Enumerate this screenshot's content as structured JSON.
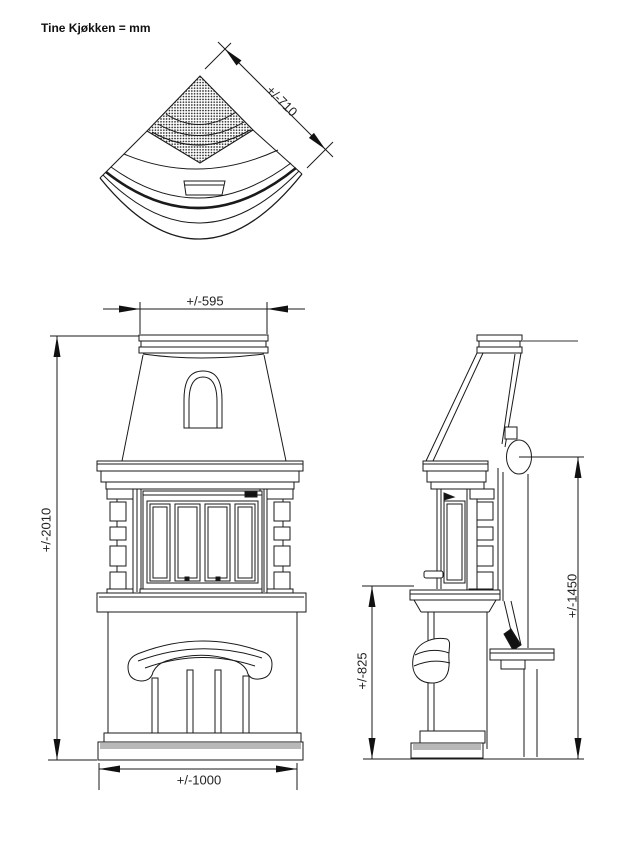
{
  "title": "Tine Kjøkken = mm",
  "drawing": {
    "top_view": {
      "side_depth": "+/-710"
    },
    "front_view": {
      "top_width": "+/-595",
      "total_height": "+/-2010",
      "base_width": "+/-1000"
    },
    "side_view": {
      "hearth_height": "+/-825",
      "flue_outlet_height": "+/-1450"
    },
    "colors": {
      "line": "#1a1a1a",
      "shading_gray": "#b8b8b8",
      "background": "#ffffff"
    }
  }
}
